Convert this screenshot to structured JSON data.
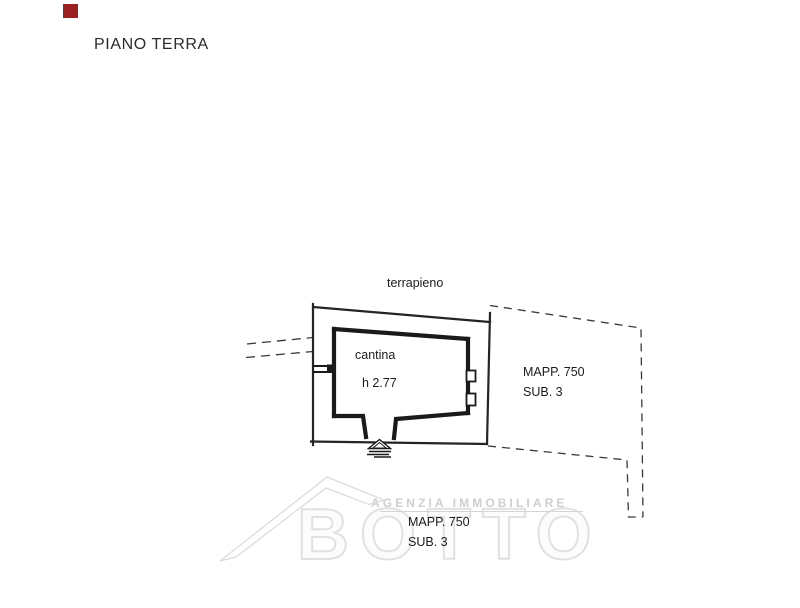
{
  "page": {
    "title": "PIANO TERRA",
    "background_color": "#ffffff",
    "marker_color": "#9b2020"
  },
  "plan": {
    "area_label": "terrapieno",
    "room": {
      "name": "cantina",
      "height": "h 2.77"
    },
    "parcel_right": {
      "line1": "MAPP. 750",
      "line2": "SUB. 3"
    },
    "parcel_bottom": {
      "line1": "MAPP. 750",
      "line2": "SUB. 3"
    },
    "line_color": "#1f1f1f"
  },
  "watermark": {
    "agency": "AGENZIA IMMOBILIARE",
    "brand": "BOTTO",
    "color": "#d9d9d9"
  }
}
